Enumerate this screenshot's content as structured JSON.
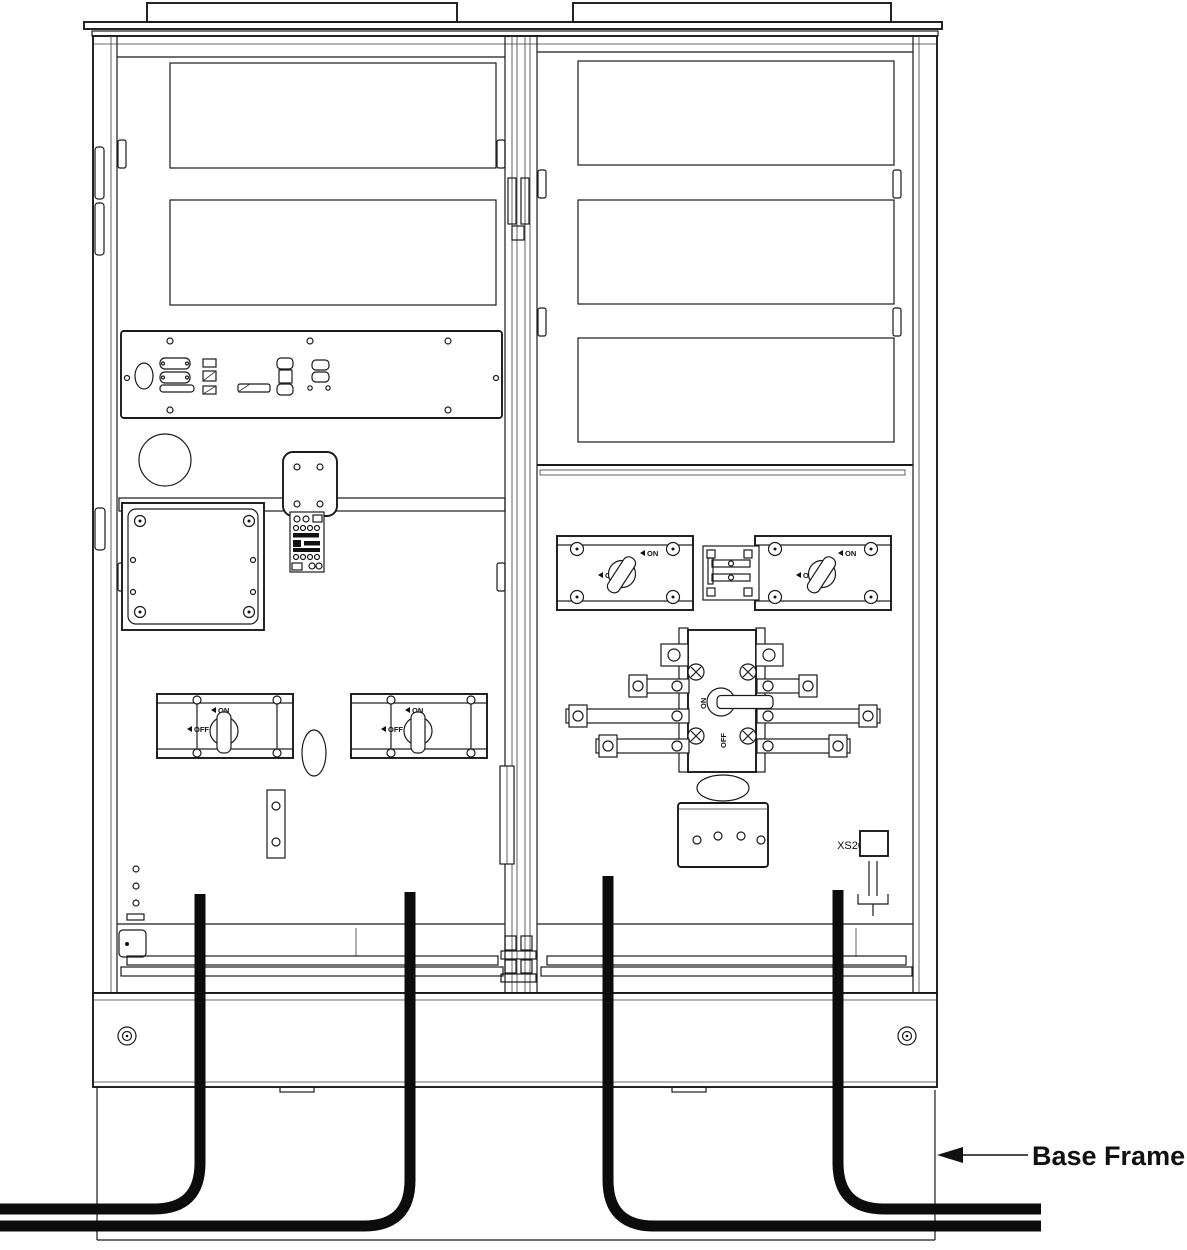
{
  "diagram": {
    "type": "technical-line-drawing",
    "subject": "Power cabinet front view (covers removed) with input/output cables routed through the base frame",
    "callouts": [
      {
        "label": "Base Frame",
        "points_to": "right edge of cabinet base frame"
      }
    ]
  },
  "labels": {
    "base_frame": "Base Frame",
    "connector_xs20": "XS20",
    "switch_on": "ON",
    "switch_off": "OFF"
  },
  "components": {
    "left_section": {
      "fan_rows": 2,
      "fans_per_row": 3,
      "rotary_switches": 2,
      "relay_modules": 4,
      "dsub_connectors": 6
    },
    "right_section": {
      "fan_rows": 3,
      "fans_per_row": 3,
      "rotary_switches": 2,
      "bypass_switches": 1,
      "terminal_blocks": 8
    },
    "cables": {
      "count": 4,
      "exit_left": 2,
      "exit_right": 2
    }
  },
  "colors": {
    "line": "#1a1a1a",
    "cable": "#0c0c0c",
    "background": "#ffffff"
  }
}
